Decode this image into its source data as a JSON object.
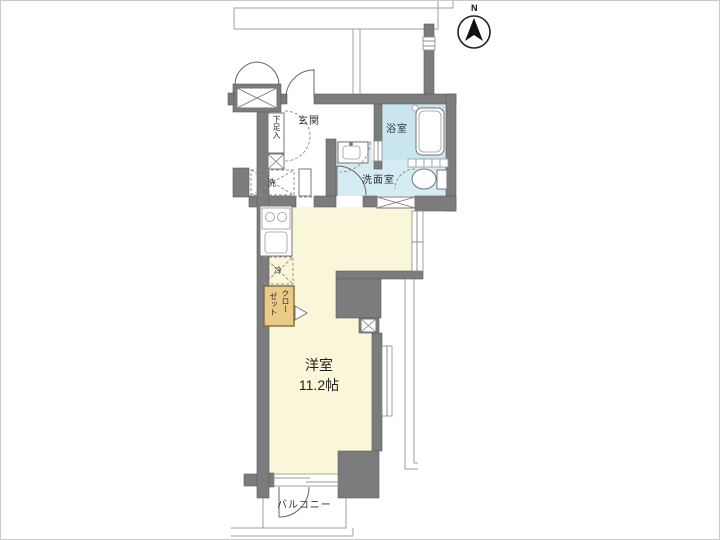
{
  "title": "apartment-floor-plan",
  "compass": {
    "north_label": "N"
  },
  "rooms": {
    "entrance": {
      "label": "玄関"
    },
    "shoe_cabinet": {
      "label": "下足入"
    },
    "bathroom": {
      "label": "浴室"
    },
    "washroom": {
      "label": "洗面室"
    },
    "washer_space": {
      "label": "洗"
    },
    "fridge_space": {
      "label": "冷"
    },
    "closet": {
      "label_col_right": "クロー",
      "label_col_left": "ゼット",
      "full_label": "クローゼット"
    },
    "main_room": {
      "label": "洋室",
      "size": "11.2帖"
    },
    "balcony": {
      "label": "バルコニー"
    }
  },
  "colors": {
    "wall": "#7c7c7c",
    "room": "#f9f6d9",
    "wet": "#d6ecf4",
    "bath": "#c9e6f0",
    "closet": "#ebc987",
    "outline": "#9f9f9f"
  }
}
